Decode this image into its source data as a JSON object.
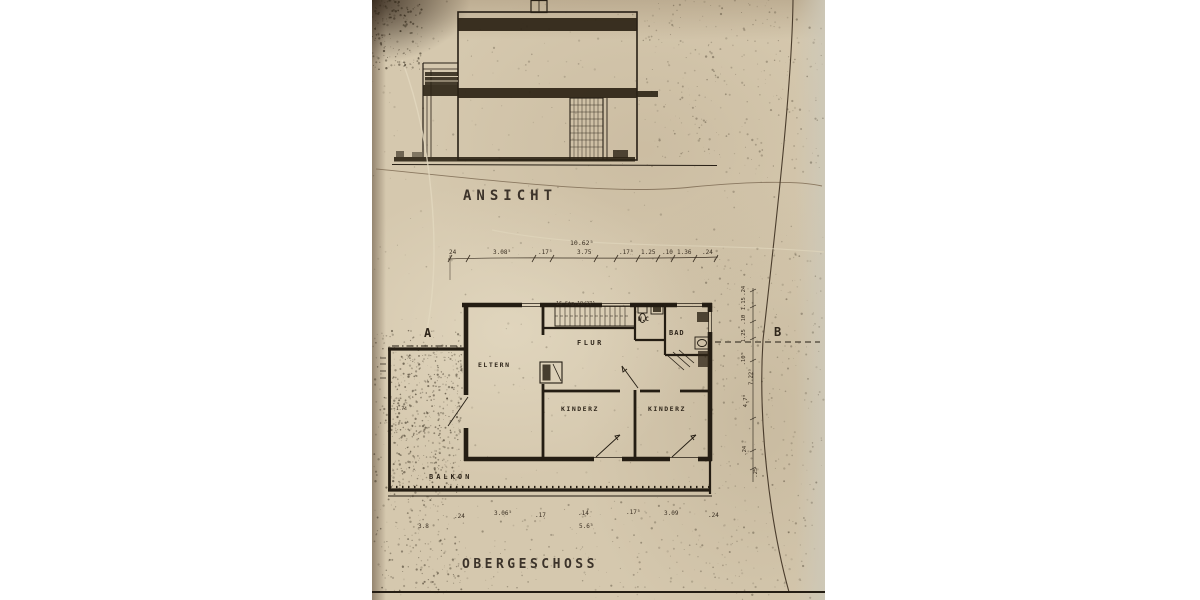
{
  "photo": {
    "description": "scanned architectural blueprint on beige paper",
    "paper_color": "#d5c8ae",
    "ink_color": "#271f15"
  },
  "elevation": {
    "title": "ANSICHT"
  },
  "plan": {
    "title": "OBERGESCHOSS",
    "rooms": {
      "eltern": "ELTERN",
      "flur": "FLUR",
      "wc": "W.C",
      "bad": "BAD",
      "kinderz1": "KINDERZ",
      "kinderz2": "KINDERZ",
      "balkon": "BALKON"
    },
    "markers": {
      "a": "A",
      "b": "B"
    },
    "stair_note": "16 Stg.19/27⁵",
    "dims": {
      "total_width": "10.62⁵",
      "top_chain": [
        "24",
        "3.08⁵",
        ".17⁵",
        "3.75",
        ".17⁵",
        "1.25",
        ".10",
        "1.36",
        ".24"
      ],
      "bottom_chain": [
        "3.8",
        ".24",
        "3.06⁵",
        ".17",
        ".14",
        ".17⁵",
        "3.09",
        ".24",
        "5.6⁵"
      ],
      "right_chain": [
        ".24",
        "1.15",
        ".10",
        "1.25",
        ".10⁵",
        "7.22⁵",
        "4.7⁸",
        ".24",
        ".25"
      ],
      "left_dim": "1.74"
    }
  }
}
